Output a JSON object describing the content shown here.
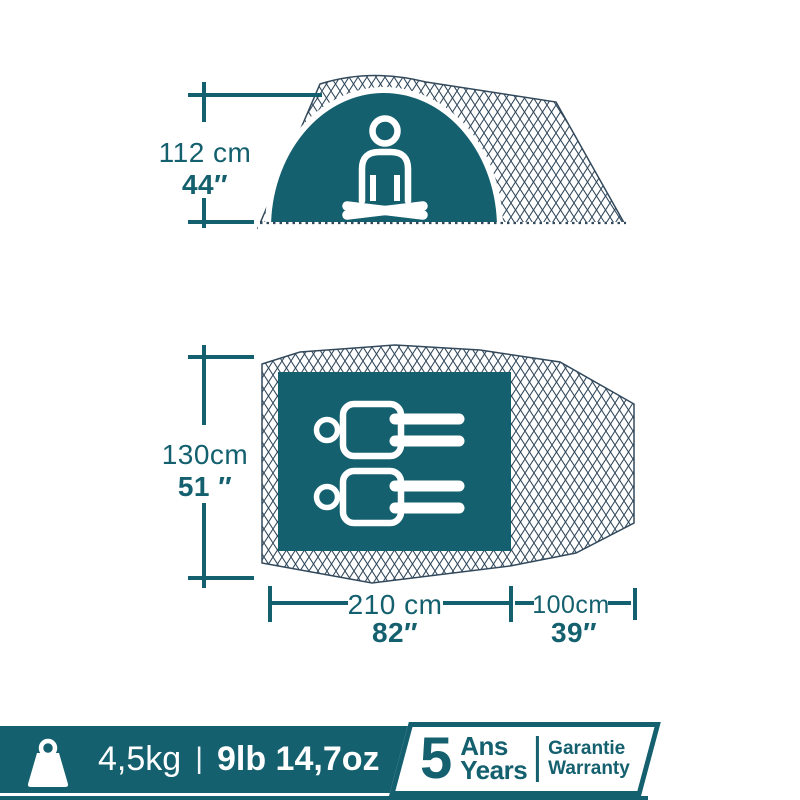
{
  "colors": {
    "teal": "#14606e",
    "lattice_line": "#32495c",
    "background": "#ffffff"
  },
  "side_view": {
    "height_metric": "112 cm",
    "height_imperial": "44″",
    "icon": "meditating-person-icon"
  },
  "floor_plan": {
    "width_metric": "130cm",
    "width_imperial": "51 ″",
    "bedroom_length_metric": "210 cm",
    "bedroom_length_imperial": "82″",
    "porch_length_metric": "100cm",
    "porch_length_imperial": "39″",
    "sleeper_icons": "lying-person-icon",
    "capacity": 2
  },
  "footer": {
    "weight_icon": "weight-icon",
    "weight_metric": "4,5kg",
    "separator": "|",
    "weight_imperial": "9lb 14,7oz",
    "warranty_badge": {
      "number": "5",
      "duration_fr": "Ans",
      "duration_en": "Years",
      "label_fr": "Garantie",
      "label_en": "Warranty"
    }
  }
}
